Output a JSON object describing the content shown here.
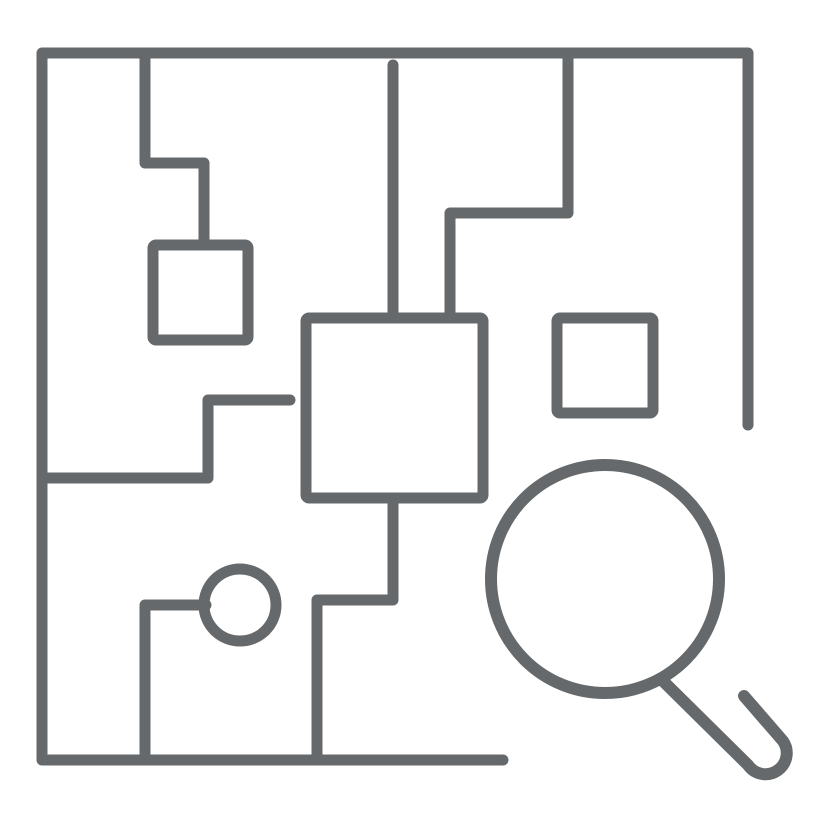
{
  "meta": {
    "canvas": {
      "width": 828,
      "height": 828
    },
    "background_color": "#ffffff"
  },
  "icon": {
    "name": "maze-search-icon",
    "description": "Line-art icon of a maze / circuit-board pattern inside an open square border with a magnifying glass overlapping the bottom-right corner",
    "stroke_color": "#66696B",
    "stroke_width": 11,
    "shapes": [
      {
        "name": "outer-border",
        "type": "path",
        "d": "M 748 425 L 748 53 L 42 53 L 42 760 L 503 760"
      },
      {
        "name": "top-left-step-line",
        "type": "path",
        "d": "M 145 53 L 145 163 L 204 163 L 204 245"
      },
      {
        "name": "left-small-square",
        "type": "rect",
        "x": 153,
        "y": 245,
        "width": 95,
        "height": 95,
        "rx": 3
      },
      {
        "name": "top-center-drop-line",
        "type": "path",
        "d": "M 393 65 L 393 318"
      },
      {
        "name": "top-right-step-line",
        "type": "path",
        "d": "M 568 53 L 568 213 L 450 213 L 450 318"
      },
      {
        "name": "central-square",
        "type": "rect",
        "x": 306,
        "y": 318,
        "width": 177,
        "height": 180,
        "rx": 3
      },
      {
        "name": "right-small-square",
        "type": "rect",
        "x": 557,
        "y": 318,
        "width": 96,
        "height": 95,
        "rx": 3
      },
      {
        "name": "left-mid-step-line",
        "type": "path",
        "d": "M 290 400 L 208 400 L 208 478 L 42 478"
      },
      {
        "name": "center-bottom-step-line",
        "type": "path",
        "d": "M 393 498 L 393 600 L 317 600 L 317 760"
      },
      {
        "name": "bottom-left-step-line",
        "type": "path",
        "d": "M 145 760 L 145 605 L 206 605"
      },
      {
        "name": "small-circle-node",
        "type": "circle",
        "cx": 240,
        "cy": 605,
        "r": 36
      },
      {
        "name": "magnifier-lens-circle",
        "type": "circle",
        "cx": 605,
        "cy": 579,
        "r": 114,
        "stroke_width": 12
      },
      {
        "name": "magnifier-handle",
        "type": "path",
        "d": "M 663 681 L 748 765 A 21 21 0 0 0 783 741 L 744 696",
        "stroke_width": 12
      }
    ]
  }
}
